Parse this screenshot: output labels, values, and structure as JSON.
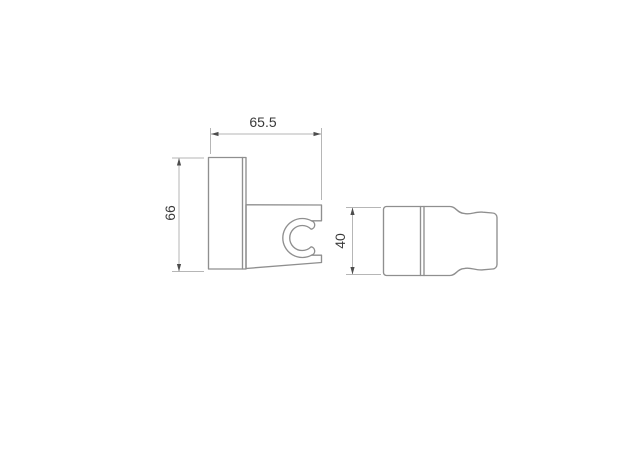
{
  "drawing": {
    "dimensions": {
      "width_top": "65.5",
      "height_left": "66",
      "height_right": "40"
    },
    "colors": {
      "outline": "#8f8f8f",
      "dimension_line": "#b6b6b6",
      "arrow": "#4d4d4d",
      "text": "#3a3a3a",
      "background": "#ffffff"
    }
  }
}
